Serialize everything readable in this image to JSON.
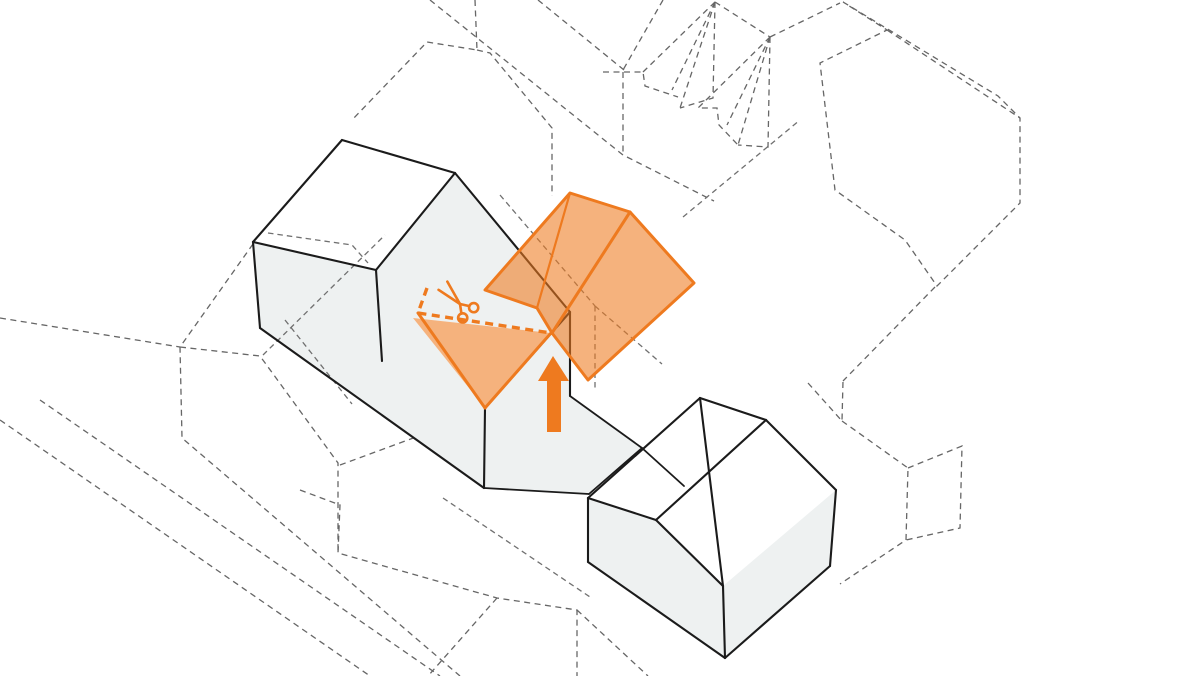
{
  "canvas": {
    "width": 1200,
    "height": 676,
    "background": "#ffffff"
  },
  "palette": {
    "context_dash_color": "#666666",
    "hidden_dash_color": "#707070",
    "solid_edge_color": "#1b1b1b",
    "wall_fill": "#eef1f1",
    "roof_fill": "#ffffff",
    "accent": "#ee7a1f",
    "accent_fill_opacity": 0.58
  },
  "diagram": {
    "type": "axonometric-architecture-diagram",
    "description": "Massing diagram: dashed context blocks, solid gabled houses, existing roof cut (scissors + dashed cut line) and new orange gable roof volume lifted in with an upward arrow.",
    "context_dashed_polylines": [
      [
        [
          475,
          0
        ],
        [
          477,
          50
        ],
        [
          427,
          42
        ],
        [
          352,
          120
        ]
      ],
      [
        [
          477,
          50
        ],
        [
          490,
          53
        ],
        [
          552,
          128
        ],
        [
          552,
          196
        ]
      ],
      [
        [
          430,
          0
        ],
        [
          623,
          155
        ],
        [
          714,
          201
        ]
      ],
      [
        [
          538,
          0
        ],
        [
          624,
          70
        ]
      ],
      [
        [
          663,
          0
        ],
        [
          623,
          70
        ]
      ],
      [
        [
          623,
          72
        ],
        [
          623,
          155
        ]
      ],
      [
        [
          603,
          72
        ],
        [
          643,
          72
        ],
        [
          645,
          86
        ],
        [
          678,
          97
        ]
      ],
      [
        [
          715,
          2
        ],
        [
          643,
          72
        ]
      ],
      [
        [
          715,
          2
        ],
        [
          672,
          90
        ]
      ],
      [
        [
          715,
          2
        ],
        [
          680,
          108
        ]
      ],
      [
        [
          715,
          2
        ],
        [
          713,
          98
        ],
        [
          680,
          108
        ]
      ],
      [
        [
          715,
          2
        ],
        [
          770,
          37
        ]
      ],
      [
        [
          770,
          37
        ],
        [
          698,
          108
        ],
        [
          717,
          108
        ],
        [
          719,
          125
        ],
        [
          738,
          145
        ]
      ],
      [
        [
          770,
          37
        ],
        [
          727,
          125
        ]
      ],
      [
        [
          770,
          37
        ],
        [
          738,
          145
        ]
      ],
      [
        [
          770,
          37
        ],
        [
          768,
          147
        ],
        [
          738,
          145
        ]
      ],
      [
        [
          770,
          37
        ],
        [
          840,
          3
        ]
      ],
      [
        [
          843,
          2
        ],
        [
          998,
          96
        ],
        [
          1020,
          118
        ],
        [
          1020,
          203
        ],
        [
          937,
          286
        ],
        [
          905,
          240
        ],
        [
          835,
          190
        ],
        [
          820,
          63
        ],
        [
          887,
          30
        ],
        [
          843,
          2
        ]
      ],
      [
        [
          887,
          30
        ],
        [
          1020,
          118
        ]
      ],
      [
        [
          935,
          287
        ],
        [
          843,
          381
        ]
      ],
      [
        [
          808,
          383
        ],
        [
          842,
          421
        ],
        [
          843,
          381
        ]
      ],
      [
        [
          842,
          421
        ],
        [
          908,
          468
        ],
        [
          906,
          540
        ],
        [
          840,
          584
        ]
      ],
      [
        [
          908,
          468
        ],
        [
          962,
          446
        ],
        [
          960,
          528
        ],
        [
          906,
          540
        ]
      ],
      [
        [
          300,
          490
        ],
        [
          340,
          505
        ],
        [
          338,
          553
        ],
        [
          497,
          598
        ],
        [
          577,
          610
        ],
        [
          577,
          676
        ]
      ],
      [
        [
          497,
          598
        ],
        [
          428,
          676
        ]
      ],
      [
        [
          577,
          610
        ],
        [
          648,
          676
        ]
      ],
      [
        [
          253,
          244
        ],
        [
          180,
          347
        ],
        [
          182,
          438
        ],
        [
          460,
          676
        ]
      ],
      [
        [
          180,
          347
        ],
        [
          260,
          356
        ],
        [
          338,
          463
        ],
        [
          338,
          553
        ]
      ],
      [
        [
          0,
          318
        ],
        [
          180,
          347
        ]
      ],
      [
        [
          0,
          420
        ],
        [
          370,
          676
        ]
      ],
      [
        [
          40,
          400
        ],
        [
          440,
          676
        ]
      ],
      [
        [
          340,
          465
        ],
        [
          484,
          412
        ]
      ]
    ],
    "building_fills": [
      {
        "name": "left-house-roof",
        "kind": "roof",
        "points": [
          [
            253,
            242
          ],
          [
            342,
            140
          ],
          [
            455,
            173
          ],
          [
            376,
            270
          ]
        ]
      },
      {
        "name": "left-complex-walls",
        "kind": "wall",
        "points": [
          [
            253,
            242
          ],
          [
            376,
            270
          ],
          [
            455,
            173
          ],
          [
            570,
            312
          ],
          [
            570,
            396
          ],
          [
            642,
            448
          ],
          [
            589,
            494
          ],
          [
            484,
            488
          ],
          [
            260,
            328
          ]
        ]
      },
      {
        "name": "right-house-roof-left",
        "kind": "roof",
        "points": [
          [
            588,
            498
          ],
          [
            700,
            398
          ],
          [
            766,
            420
          ],
          [
            656,
            520
          ]
        ]
      },
      {
        "name": "right-house-roof-right",
        "kind": "roof",
        "points": [
          [
            700,
            398
          ],
          [
            766,
            420
          ],
          [
            836,
            490
          ],
          [
            723,
            586
          ]
        ]
      },
      {
        "name": "right-house-front-wall",
        "kind": "wall",
        "points": [
          [
            588,
            498
          ],
          [
            654,
            519
          ],
          [
            723,
            586
          ],
          [
            725,
            658
          ],
          [
            588,
            562
          ]
        ]
      },
      {
        "name": "right-house-side-wall",
        "kind": "wall",
        "points": [
          [
            836,
            490
          ],
          [
            830,
            566
          ],
          [
            725,
            658
          ],
          [
            723,
            586
          ]
        ]
      },
      {
        "name": "cut-roof-plane-under",
        "kind": "roof",
        "points": [
          [
            413,
            318
          ],
          [
            551,
            333
          ],
          [
            485,
            408
          ]
        ]
      }
    ],
    "hidden_dashed_polylines": [
      [
        [
          500,
          195
        ],
        [
          595,
          306
        ]
      ],
      [
        [
          595,
          306
        ],
        [
          595,
          390
        ]
      ],
      [
        [
          595,
          306
        ],
        [
          662,
          364
        ]
      ],
      [
        [
          683,
          217
        ],
        [
          800,
          120
        ]
      ],
      [
        [
          285,
          320
        ],
        [
          352,
          404
        ]
      ],
      [
        [
          268,
          233
        ],
        [
          352,
          245
        ],
        [
          368,
          263
        ]
      ],
      [
        [
          263,
          355
        ],
        [
          385,
          235
        ]
      ],
      [
        [
          443,
          498
        ],
        [
          590,
          597
        ]
      ]
    ],
    "solid_edges": [
      {
        "pts": [
          [
            253,
            242
          ],
          [
            342,
            140
          ]
        ]
      },
      {
        "pts": [
          [
            342,
            140
          ],
          [
            455,
            173
          ]
        ]
      },
      {
        "pts": [
          [
            455,
            173
          ],
          [
            376,
            270
          ]
        ]
      },
      {
        "pts": [
          [
            376,
            270
          ],
          [
            253,
            242
          ]
        ]
      },
      {
        "pts": [
          [
            253,
            242
          ],
          [
            260,
            328
          ]
        ]
      },
      {
        "pts": [
          [
            260,
            328
          ],
          [
            484,
            488
          ]
        ]
      },
      {
        "pts": [
          [
            376,
            270
          ],
          [
            382,
            361
          ]
        ]
      },
      {
        "pts": [
          [
            455,
            173
          ],
          [
            570,
            312
          ]
        ]
      },
      {
        "pts": [
          [
            570,
            312
          ],
          [
            485,
            408
          ]
        ]
      },
      {
        "pts": [
          [
            485,
            408
          ],
          [
            484,
            488
          ]
        ]
      },
      {
        "pts": [
          [
            570,
            312
          ],
          [
            570,
            396
          ]
        ]
      },
      {
        "pts": [
          [
            570,
            396
          ],
          [
            642,
            448
          ]
        ],
        "w": 1.8
      },
      {
        "pts": [
          [
            642,
            448
          ],
          [
            589,
            494
          ]
        ],
        "w": 1.8
      },
      {
        "pts": [
          [
            589,
            494
          ],
          [
            484,
            488
          ]
        ],
        "w": 1.8
      },
      {
        "pts": [
          [
            642,
            448
          ],
          [
            684,
            486
          ]
        ],
        "w": 1.8
      },
      {
        "pts": [
          [
            588,
            498
          ],
          [
            700,
            398
          ]
        ]
      },
      {
        "pts": [
          [
            700,
            398
          ],
          [
            766,
            420
          ]
        ]
      },
      {
        "pts": [
          [
            766,
            420
          ],
          [
            836,
            490
          ]
        ]
      },
      {
        "pts": [
          [
            700,
            398
          ],
          [
            723,
            586
          ]
        ]
      },
      {
        "pts": [
          [
            588,
            498
          ],
          [
            656,
            520
          ]
        ]
      },
      {
        "pts": [
          [
            656,
            520
          ],
          [
            723,
            586
          ]
        ]
      },
      {
        "pts": [
          [
            766,
            420
          ],
          [
            656,
            520
          ]
        ]
      },
      {
        "pts": [
          [
            836,
            490
          ],
          [
            830,
            566
          ]
        ]
      },
      {
        "pts": [
          [
            830,
            566
          ],
          [
            725,
            658
          ]
        ]
      },
      {
        "pts": [
          [
            725,
            658
          ],
          [
            588,
            562
          ]
        ]
      },
      {
        "pts": [
          [
            588,
            562
          ],
          [
            588,
            498
          ]
        ]
      },
      {
        "pts": [
          [
            723,
            586
          ],
          [
            725,
            658
          ]
        ]
      }
    ],
    "highlight": {
      "floating_roof_outline": [
        [
          485,
          290
        ],
        [
          570,
          193
        ],
        [
          630,
          212
        ],
        [
          694,
          283
        ],
        [
          588,
          380
        ],
        [
          552,
          333
        ],
        [
          537,
          308
        ]
      ],
      "floating_roof_folds": [
        {
          "pts": [
            [
              630,
              212
            ],
            [
              552,
              333
            ]
          ],
          "w": 3
        },
        {
          "pts": [
            [
              570,
              193
            ],
            [
              537,
              308
            ]
          ],
          "w": 2.2
        }
      ],
      "cut_roof_triangle": [
        [
          413,
          318
        ],
        [
          551,
          333
        ],
        [
          485,
          408
        ]
      ],
      "cut_roof_solid_edges": [
        {
          "pts": [
            [
              418,
              313
            ],
            [
              485,
              408
            ]
          ],
          "w": 3
        },
        {
          "pts": [
            [
              485,
              408
            ],
            [
              551,
              333
            ]
          ],
          "w": 3
        }
      ],
      "cut_line_dashed": [
        [
          427,
          288
        ],
        [
          418,
          313
        ],
        [
          551,
          333
        ]
      ],
      "arrow_points": [
        [
          553,
          356
        ],
        [
          569,
          381
        ],
        [
          561,
          381
        ],
        [
          561,
          432
        ],
        [
          547,
          432
        ],
        [
          547,
          381
        ],
        [
          538,
          381
        ]
      ],
      "scissors": {
        "cx": 460,
        "cy": 304,
        "rotation": -133,
        "blade_length": 25,
        "blade_spread": 6,
        "loop_radius": 4.6,
        "loop_offset_x": -12,
        "loop_offset_y": 7.5
      }
    }
  }
}
